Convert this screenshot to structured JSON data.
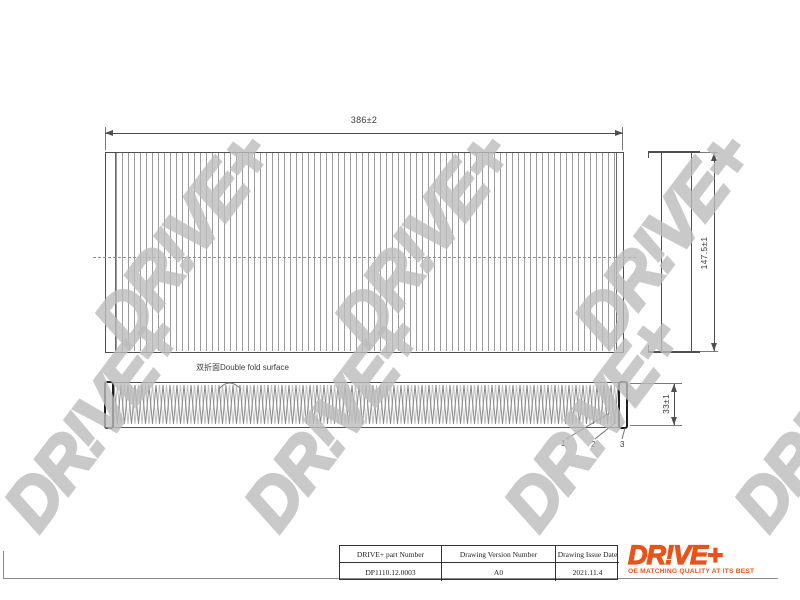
{
  "sheet": {
    "watermark_text": "DR!VE+",
    "views": {
      "top": {
        "width_dim": "386±2",
        "height_dim": "147.5±1"
      },
      "front": {
        "thickness_dim": "33±1",
        "fold_label": "双折面Double fold surface",
        "callouts": [
          "1",
          "2",
          "3"
        ]
      }
    },
    "title_block": {
      "part_number_header": "DRIVE+ part Number",
      "part_number": "DP1110.12.0003",
      "version_header": "Drawing Version Number",
      "version": "A0",
      "date_header": "Drawing Issue Date",
      "date": "2021.11.4"
    },
    "brand": {
      "logo_text": "DR!VE+",
      "tagline": "OE MATCHING QUALITY AT ITS BEST",
      "accent_color": "#e8531a"
    },
    "colors": {
      "line": "#4f4f4f",
      "hatch": "#9c9c9c",
      "watermark": "#bcbcbc",
      "accent": "#e8531a"
    }
  }
}
